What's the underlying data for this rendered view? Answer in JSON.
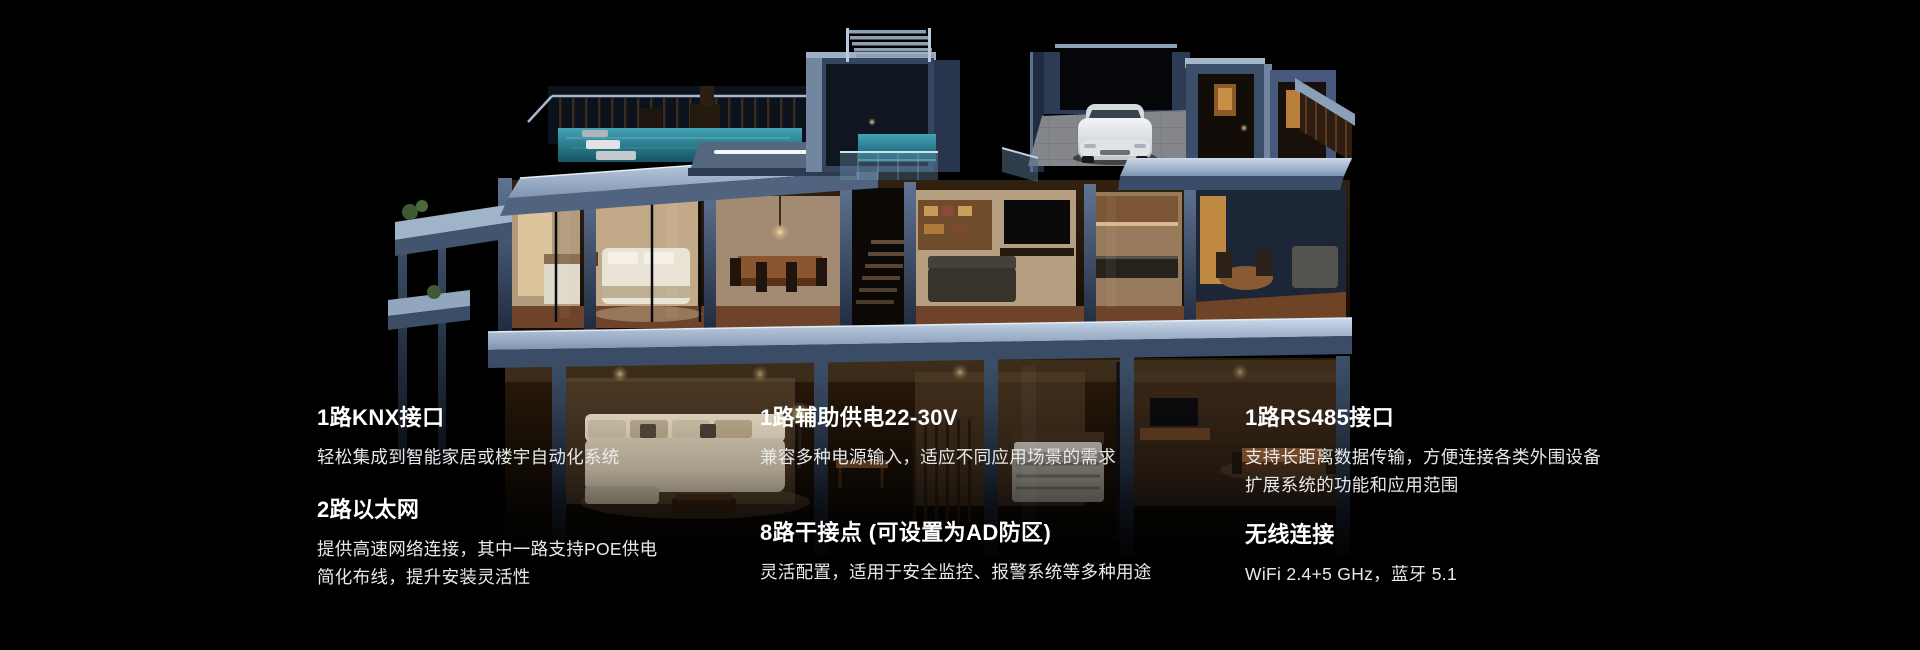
{
  "colors": {
    "background": "#000000",
    "heading_text": "#ffffff",
    "body_text": "#e9e9e9",
    "wall_slate": "#5a7191",
    "slab_light": "#aabfd6",
    "pool_water": "#2e8398",
    "interior_warm": "#c9a06b",
    "car_body": "#e6e8ea"
  },
  "features": {
    "columns": [
      {
        "blocks": [
          {
            "title": "1路KNX接口",
            "lines": [
              "轻松集成到智能家居或楼宇自动化系统"
            ]
          },
          {
            "title": "2路以太网",
            "lines": [
              "提供高速网络连接，其中一路支持POE供电",
              "简化布线，提升安装灵活性"
            ]
          }
        ]
      },
      {
        "blocks": [
          {
            "title": "1路辅助供电22-30V",
            "lines": [
              "兼容多种电源输入，适应不同应用场景的需求"
            ]
          },
          {
            "title": "8路干接点 (可设置为AD防区)",
            "lines": [
              "灵活配置，适用于安全监控、报警系统等多种用途"
            ]
          }
        ]
      },
      {
        "blocks": [
          {
            "title": "1路RS485接口",
            "lines": [
              "支持长距离数据传输，方便连接各类外围设备",
              "扩展系统的功能和应用范围"
            ]
          },
          {
            "title": "无线连接",
            "lines": [
              "WiFi 2.4+5 GHz，蓝牙 5.1"
            ]
          }
        ]
      }
    ]
  }
}
